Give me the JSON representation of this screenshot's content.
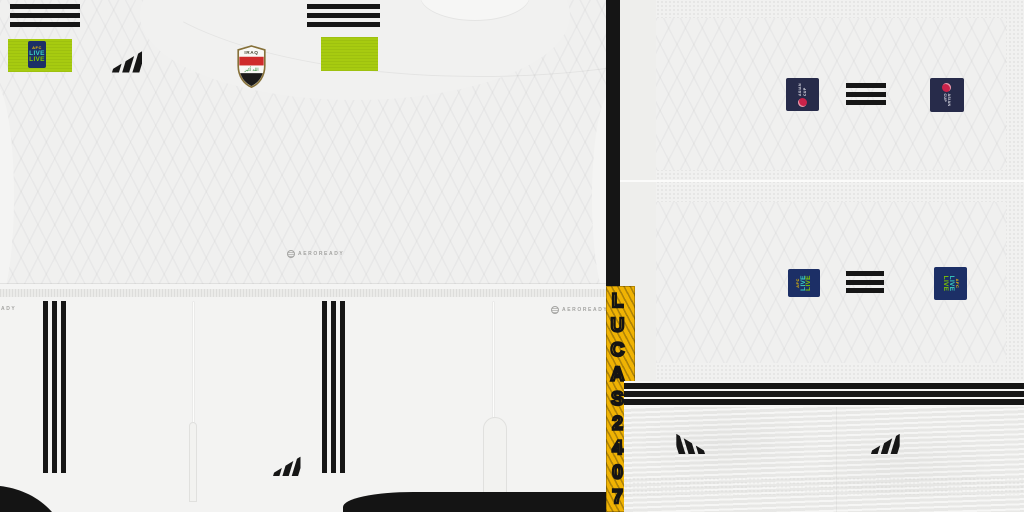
{
  "sheet": {
    "watermark_text": "LUCAS2407",
    "colors": {
      "fabric_white": "#f0f0ef",
      "stripe_black": "#161616",
      "volt_green": "#a7cb10",
      "badge_navy": "#1c2f66",
      "patch_navy": "#272b4a",
      "watermark_yellow": "#f0b303",
      "crest_red": "#cf2b2b",
      "crest_gold": "#86713a",
      "crest_green": "#2e8b3a"
    }
  },
  "shirt": {
    "aeroready_label": "AEROREADY",
    "crest": {
      "title": "IRAQ",
      "inscription": "الله أكبر"
    },
    "shoulder_badge": {
      "org": "AFC",
      "live_a": "LIVE",
      "live_b": "LIVE"
    }
  },
  "shorts": {
    "aeroready_left_label": "AEROREADY",
    "aeroready_right_label": "AEROREADY"
  },
  "sleeve_sheet": {
    "asian_cup_label": "ASIAN CUP",
    "live_badge": {
      "org": "AFC",
      "live_a": "LIVE",
      "live_b": "LIVE"
    }
  }
}
